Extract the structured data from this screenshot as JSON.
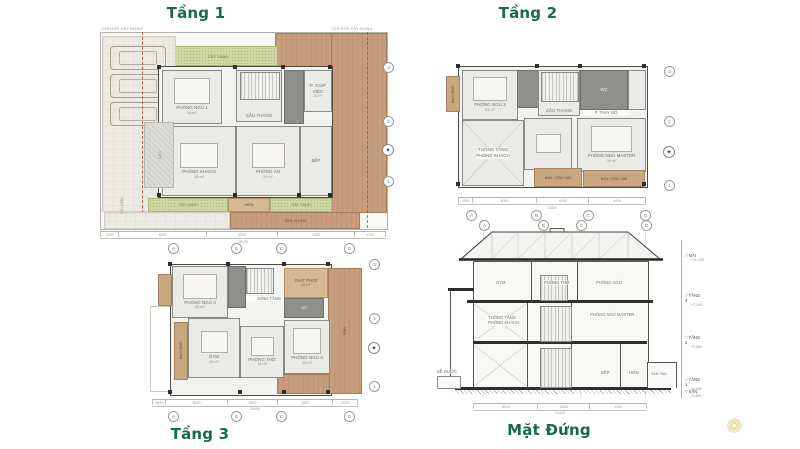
{
  "titles": {
    "floor1": "Tầng 1",
    "floor2": "Tầng 2",
    "floor3": "Tầng 3",
    "elevation": "Mặt Đứng"
  },
  "colors": {
    "title_green": "#17694b",
    "wall": "#4a4a46",
    "landscape_green": "#cdd8a2",
    "deck_tan": "#c69e7d",
    "balcony_tan": "#c9a77f",
    "dark_room": "#8f8f8c",
    "boundary_red": "#c0443a",
    "logo_gold": "#eac878"
  },
  "floor1": {
    "boundary_left": "CHỈ GIỚI XÂY DỰNG",
    "boundary_right": "CHỈ GIỚI XÂY DỰNG",
    "rooms": {
      "garden_top": "CÂY XANH",
      "bedroom1": "PHÒNG NGỦ 1",
      "bedroom1_area": "24 m²",
      "stair": "CẦU THANG",
      "maid": "P. GIÚP VIỆC",
      "maid_area": "8 m²",
      "living": "PHÒNG KHÁCH",
      "living_area": "28 m²",
      "dining": "PHÒNG ĂN",
      "dining_area": "24 m²",
      "kitchen": "BẾP",
      "court": "SÂN",
      "porch": "HIÊN",
      "garden_bl": "CÂY XANH",
      "garden_br": "CÂY XANH",
      "deck": "SÂN VƯỜN",
      "ramp": "LỐI LÊN"
    },
    "dims": [
      "1000",
      "5000",
      "4000",
      "4400",
      "1700"
    ],
    "dim_total": "16100",
    "grid_letters": [
      "A",
      "B",
      "C",
      "D"
    ],
    "grid_numbers": [
      "3",
      "2",
      "1"
    ]
  },
  "floor2": {
    "rooms": {
      "bedroom2": "PHÒNG NGỦ 2",
      "bedroom2_area": "24 m²",
      "stair": "CẦU THANG",
      "wc": "WC",
      "dressing": "P. THAY ĐỒ",
      "void_l1": "THÔNG TẦNG",
      "void_l2": "PHÒNG KHÁCH",
      "master": "PHÒNG NGỦ MASTER",
      "master_area": "36 m²",
      "balcony_left": "BAN CÔNG",
      "balcony1": "BAN CÔNG MÁI",
      "balcony2": "BAN CÔNG MÁI"
    },
    "dims": [
      "1000",
      "5000",
      "4000",
      "4400"
    ],
    "dim_total": "14400",
    "grid_letters": [
      "A",
      "B",
      "C",
      "D"
    ],
    "grid_numbers": [
      "3",
      "2",
      "1"
    ]
  },
  "floor3": {
    "rooms": {
      "bedroom3": "PHÒNG NGỦ 3",
      "bedroom3_area": "25 m²",
      "hall": "SẢNH TẦNG",
      "laundry": "GIẶT PHƠI",
      "laundry_area": "12 m²",
      "wc": "WC",
      "bedroom4": "PHÒNG NGỦ 4",
      "bedroom4_area": "26 m²",
      "gym": "GYM",
      "gym_area": "25 m²",
      "worship": "PHÒNG THỜ",
      "worship_area": "16 m²",
      "balcony": "BAN CÔNG",
      "terrace": "SÂN"
    },
    "dims": [
      "1000",
      "5000",
      "4000",
      "4400",
      "2000"
    ],
    "dim_total": "16400",
    "grid_letters": [
      "A",
      "B",
      "C",
      "D"
    ],
    "grid_numbers": [
      "3",
      "2",
      "1"
    ]
  },
  "elevation": {
    "rooms": {
      "gym": "GYM",
      "worship": "PHÒNG THỜ",
      "bedroom": "PHÒNG NGỦ",
      "void_l1": "THÔNG TẦNG",
      "void_l2": "PHÒNG KHÁCH",
      "master": "PHÒNG NGỦ MASTER",
      "kitchen": "BẾP",
      "porch": "HIÊN",
      "back_yard": "SÂN SAU",
      "tank": "BỂ NƯỚC"
    },
    "levels": [
      {
        "name": "MÁI",
        "value": "+11.100"
      },
      {
        "name": "TẦNG 3",
        "value": "+7.200"
      },
      {
        "name": "TẦNG 2",
        "value": "+3.600"
      },
      {
        "name": "TẦNG 1",
        "value": "±0.000"
      },
      {
        "name": "SÂN",
        "value": "-0.450"
      }
    ],
    "grid_letters": [
      "A",
      "B",
      "C",
      "D"
    ],
    "dims": [
      "5000",
      "4000",
      "4400"
    ],
    "dim_total": "13400"
  }
}
